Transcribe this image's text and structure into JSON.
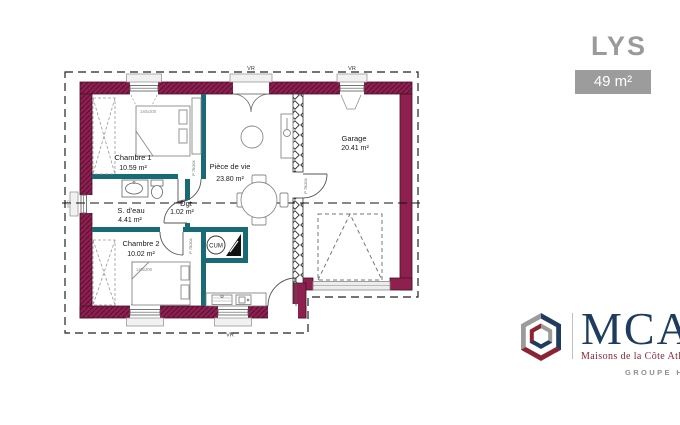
{
  "header": {
    "plan_name": "LYS",
    "area_badge": "49 m²"
  },
  "plan": {
    "rooms": {
      "chambre1": {
        "name": "Chambre 1",
        "area": "10.59 m²"
      },
      "sdeau": {
        "name": "S. d'eau",
        "area": "4.41 m²"
      },
      "chambre2": {
        "name": "Chambre 2",
        "area": "10.02 m²"
      },
      "dgt": {
        "name": "Dgt",
        "area": "1.02 m²"
      },
      "piece_de_vie": {
        "name": "Pièce de vie",
        "area": "23.80 m²"
      },
      "garage": {
        "name": "Garage",
        "area": "20.41 m²"
      }
    },
    "annotations": {
      "water_heater": "CUM",
      "bed1_size": "140x200",
      "bed2_size": "140x200",
      "shutter": "VR",
      "window_label": "F60",
      "door_label": "P 75/204"
    },
    "colors": {
      "exterior_wall": "#8e2050",
      "interior_wall": "#186b75",
      "brand_navy": "#1e3c5e",
      "brand_crimson": "#8c2332",
      "brand_gray": "#9b9b9b"
    }
  },
  "logo": {
    "brand": "MCA",
    "tagline": "Maisons de la Côte Atlantique",
    "group": "GROUPE HEXA"
  }
}
